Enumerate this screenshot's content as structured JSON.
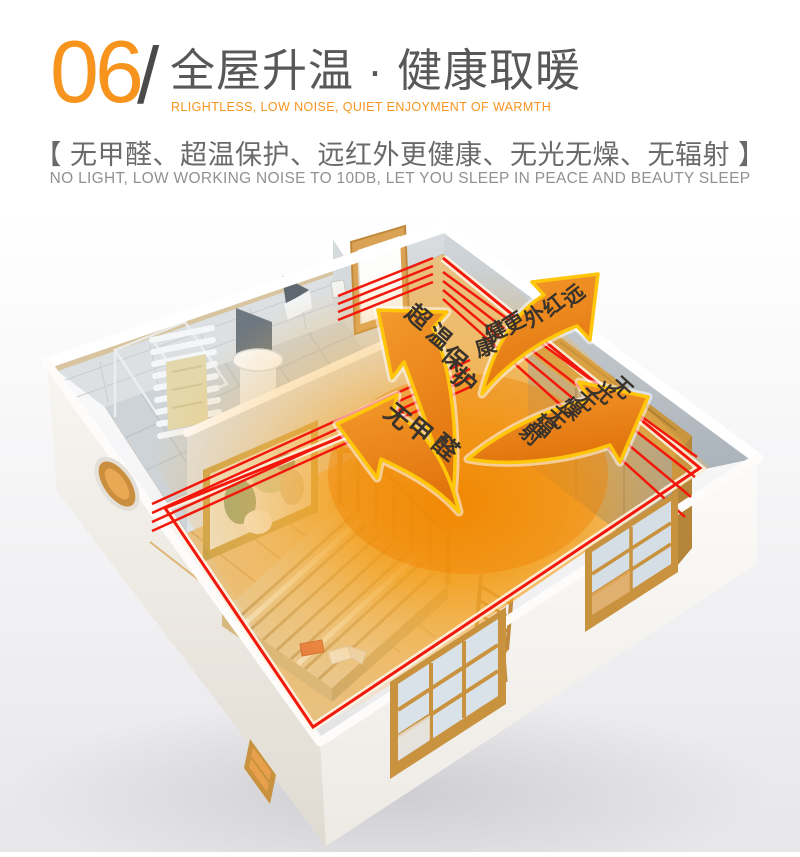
{
  "header": {
    "section_number": "06",
    "divider": "/",
    "title": "全屋升温 · 健康取暖",
    "subtitle_en": "RLIGHTLESS, LOW NOISE, QUIET ENJOYMENT OF WARMTH",
    "features_line": "【 无甲醛、超温保护、远红外更健康、无光无燥、无辐射 】",
    "features_en": "NO LIGHT, LOW WORKING NOISE TO 10DB, LET YOU SLEEP IN PEACE AND BEAUTY SLEEP"
  },
  "illustration": {
    "description": "isometric cutaway room with heating pipes and radiating warmth arrows",
    "arrows": [
      {
        "id": "overheat-protection",
        "label": "超温保护"
      },
      {
        "id": "far-infrared",
        "label": "远红外更健康"
      },
      {
        "id": "no-light-no-dryness",
        "label": "无光无燥无辐射"
      },
      {
        "id": "no-formaldehyde",
        "label": "无甲醛"
      }
    ],
    "colors": {
      "accent_orange": "#F7941E",
      "arrow_orange": "#EE8522",
      "arrow_outline": "#FFC60A",
      "pipe_red": "#F2190C",
      "title_gray": "#595757",
      "glow_orange": "#F59C16"
    }
  }
}
